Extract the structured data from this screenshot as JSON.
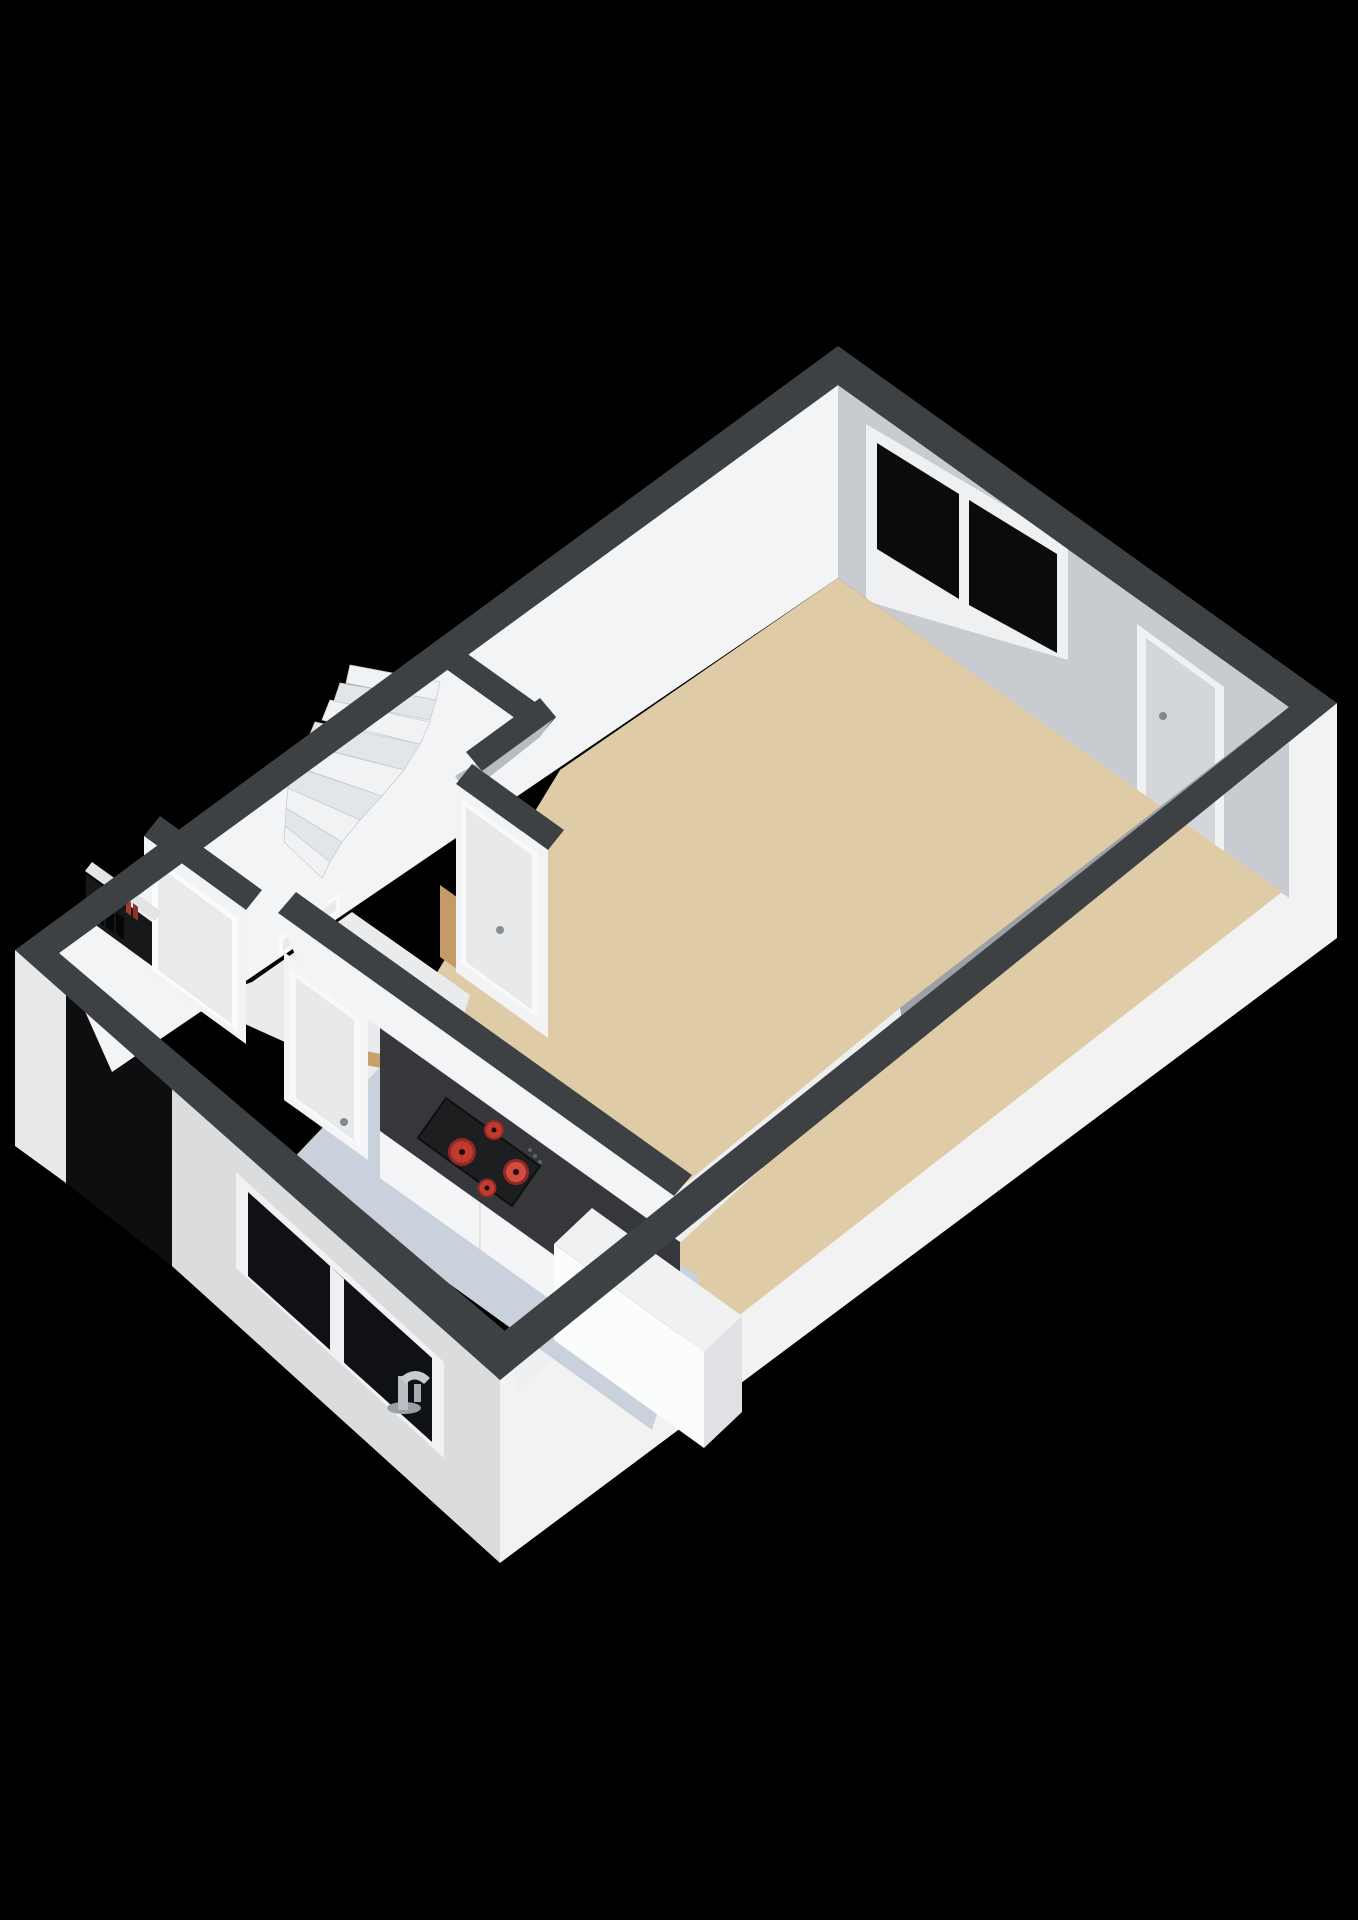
{
  "scene": {
    "kind": "3d-floorplan-render",
    "floor_shown": "ground-floor-open-plan-with-winder-stairs",
    "burner_count": 4
  },
  "colors": {
    "background": "#000000",
    "wall_band": "#3e4143",
    "nw_face": "#f3f4f6",
    "ne_face": "#c8ccd1",
    "se_strip_dark": "#9ba1a7",
    "se_strip_light": "#edeff1",
    "se_exterior": "#f2f2f3",
    "sw_exterior": "#dadcde",
    "sw_sliver": "#e7e8ea",
    "shadow_notch": "#0e0e10",
    "living_floor": "#dfcca6",
    "kitchen_floor": "#c9d1dc",
    "hall_floor": "#e9ebed",
    "stair_light": "#f1f2f4",
    "stair_dark": "#e3e6e9",
    "counter_top": "#35373a",
    "cabinet_front": "#f4f5f6",
    "cooktop": "#1d1e20",
    "burner_outer": "#8e2a24",
    "burner_mid": "#c13a31",
    "burner_inner": "#d24b40",
    "island_top": "#eff1f2",
    "island_front": "#fbfcfc",
    "island_side": "#dfe1e4",
    "glass": "#0a0b0d",
    "window_frame": "#eef0f2",
    "door_panel": "#d4d7da",
    "door_panel_light": "#e7e9eb",
    "wood": "#c49b66",
    "wood_light": "#c9a06a",
    "gray_face": "#b6bcc2",
    "meter_dark": "#17181a",
    "meter_black": "#070708",
    "meter_red": "#a63a2e",
    "chrome": "#b9bec4"
  }
}
